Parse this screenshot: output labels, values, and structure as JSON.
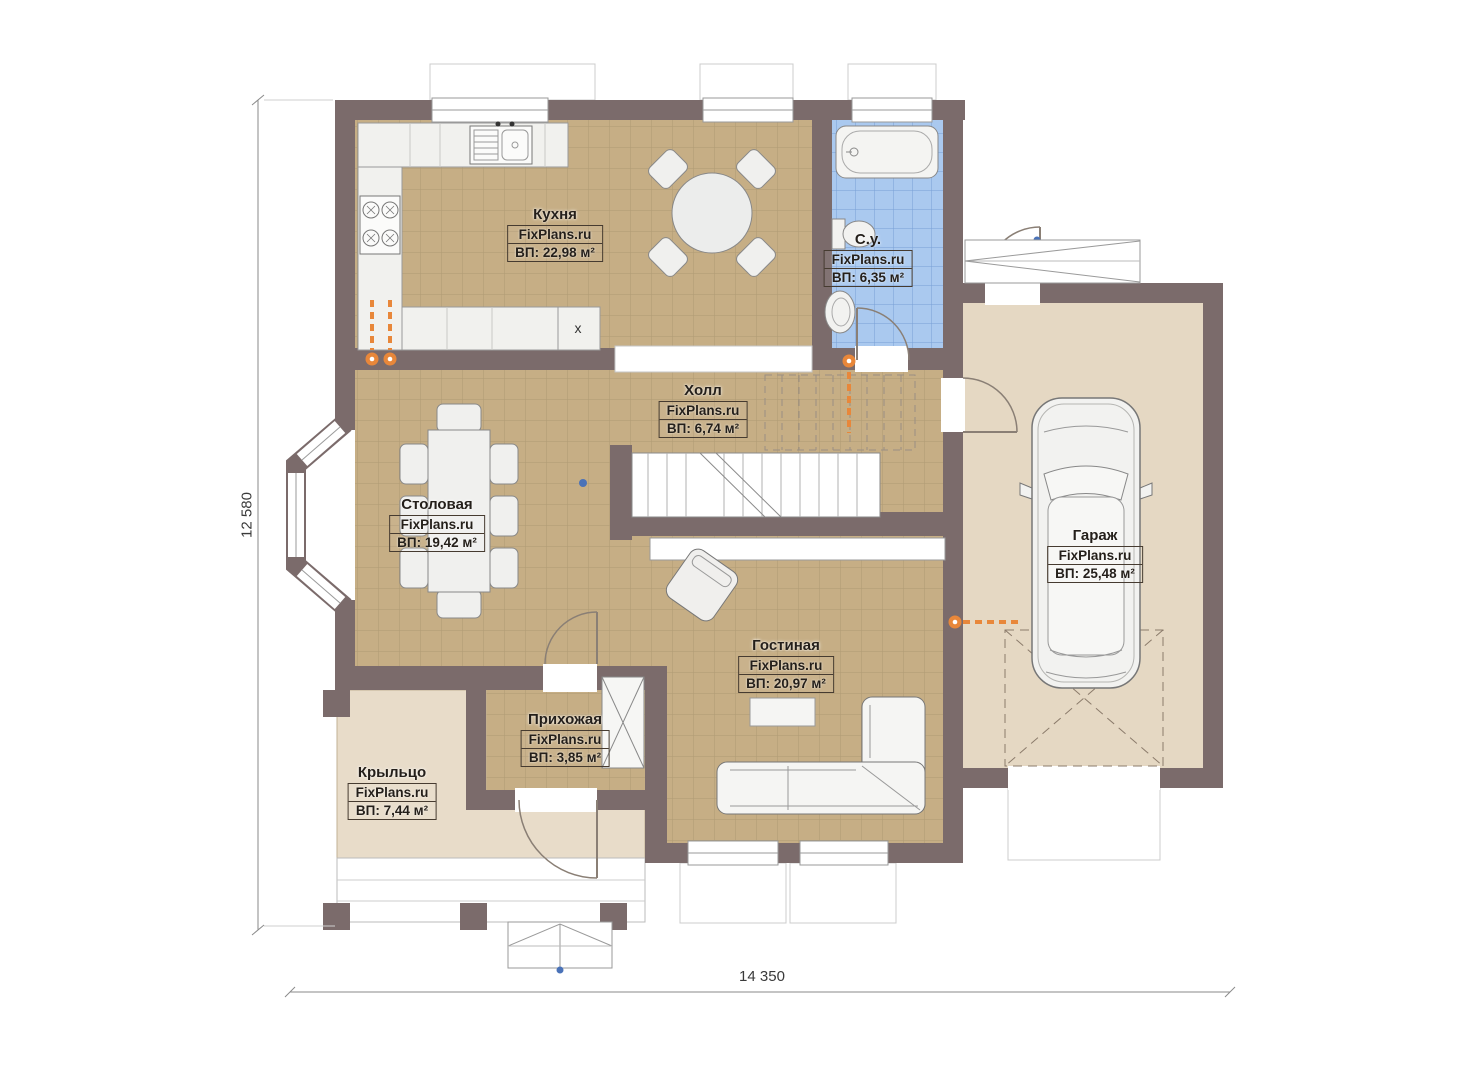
{
  "plan": {
    "rooms": [
      {
        "id": "kitchen",
        "name": "Кухня",
        "watermark": "FixPlans.ru",
        "area": "ВП: 22,98 м²"
      },
      {
        "id": "bathroom",
        "name": "С.у.",
        "watermark": "FixPlans.ru",
        "area": "ВП: 6,35 м²"
      },
      {
        "id": "hall",
        "name": "Холл",
        "watermark": "FixPlans.ru",
        "area": "ВП: 6,74 м²"
      },
      {
        "id": "dining",
        "name": "Столовая",
        "watermark": "FixPlans.ru",
        "area": "ВП: 19,42 м²"
      },
      {
        "id": "garage",
        "name": "Гараж",
        "watermark": "FixPlans.ru",
        "area": "ВП: 25,48 м²"
      },
      {
        "id": "living",
        "name": "Гостиная",
        "watermark": "FixPlans.ru",
        "area": "ВП: 20,97 м²"
      },
      {
        "id": "entry",
        "name": "Прихожая",
        "watermark": "FixPlans.ru",
        "area": "ВП: 3,85 м²"
      },
      {
        "id": "porch",
        "name": "Крыльцо",
        "watermark": "FixPlans.ru",
        "area": "ВП: 7,44 м²"
      }
    ],
    "kitchen_cabinet_mark": "x",
    "dimensions": {
      "height": "12 580",
      "width": "14 350"
    },
    "colors": {
      "wall": "#7b6b6b",
      "floor_tile": "#c6ae85",
      "bathroom_tile": "#aac9ef",
      "garage_floor": "#e5d8c3",
      "porch_floor": "#e8dcc9",
      "radiator": "#e8873a",
      "hinge_dot": "#4a72b8"
    }
  }
}
